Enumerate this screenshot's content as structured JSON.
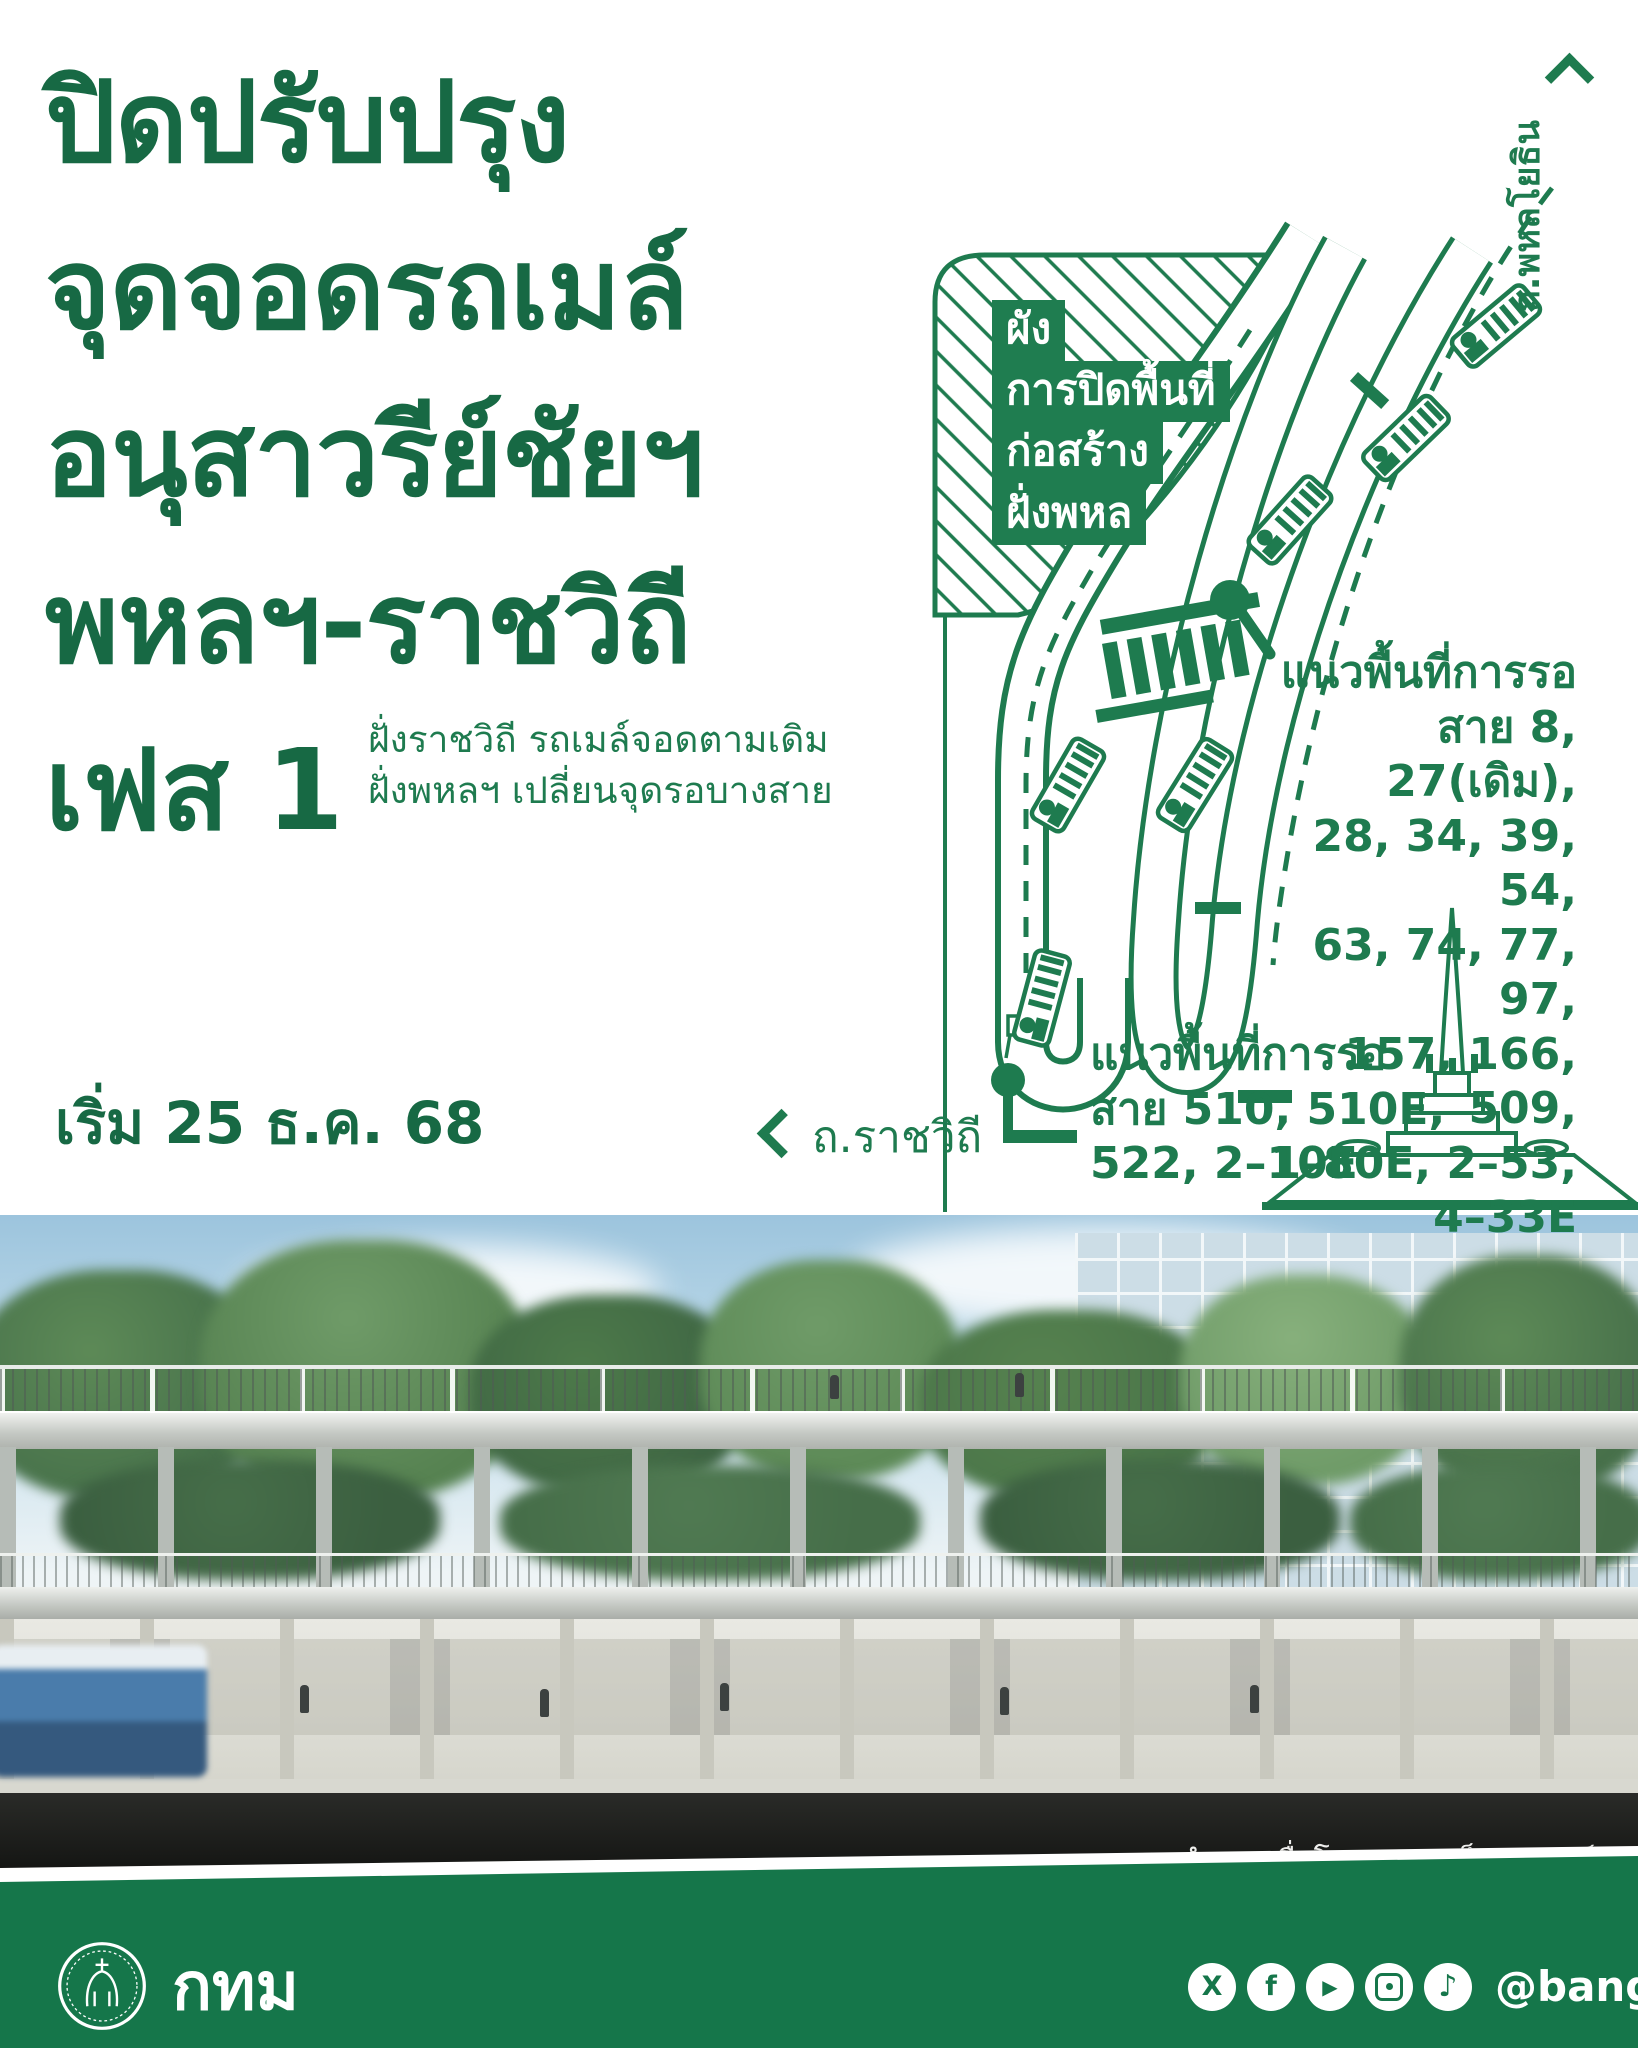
{
  "colors": {
    "headline_green": "#176944",
    "map_green": "#1E7B4F",
    "label_box_green": "#1F7D50",
    "footer_green": "#15764A"
  },
  "header": {
    "title_lines": [
      "ปิดปรับปรุง",
      "จุดจอดรถเมล์",
      "อนุสาวรีย์ชัยฯ",
      "พหลฯ-ราชวิถี"
    ],
    "phase_label": "เฟส 1",
    "phase_notes": [
      "ฝั่งราชวิถี รถเมล์จอดตามเดิม",
      "ฝั่งพหลฯ เปลี่ยนจุดรอบางสาย"
    ],
    "start_date": "เริ่ม 25 ธ.ค. 68"
  },
  "map": {
    "closure_label_lines": [
      "ผัง",
      "การปิดพื้นที่",
      "ก่อสร้าง",
      "ฝั่งพหล"
    ],
    "road_phahonyothin": "ถ.พหลโยธิน",
    "road_ratchawithi": "ถ.ราชวิถี",
    "wait_area_phahon": {
      "title": "แนวพื้นที่การรอ",
      "lines": [
        "สาย 8, 27(เดิม),",
        "28, 34, 39, 54,",
        "63, 74, 77, 97,",
        "157, 166, 509,",
        "1–80E, 2–53,",
        "4–33E"
      ]
    },
    "wait_area_ratchawithi": {
      "title": "แนวพื้นที่การรอ",
      "lines": [
        "สาย 510, 510E,",
        "522, 2–10E"
      ]
    }
  },
  "photo": {
    "caption": "ภาพจำลองเมื่อโครงการเสร็จสมบูรณ์"
  },
  "footer": {
    "org_name": "กทม",
    "social_handle": "@bangkokbma",
    "social": [
      {
        "name": "x",
        "glyph": "X"
      },
      {
        "name": "facebook",
        "glyph": "f"
      },
      {
        "name": "youtube",
        "glyph": "▶"
      },
      {
        "name": "instagram",
        "glyph": ""
      },
      {
        "name": "tiktok",
        "glyph": "♪"
      }
    ]
  }
}
